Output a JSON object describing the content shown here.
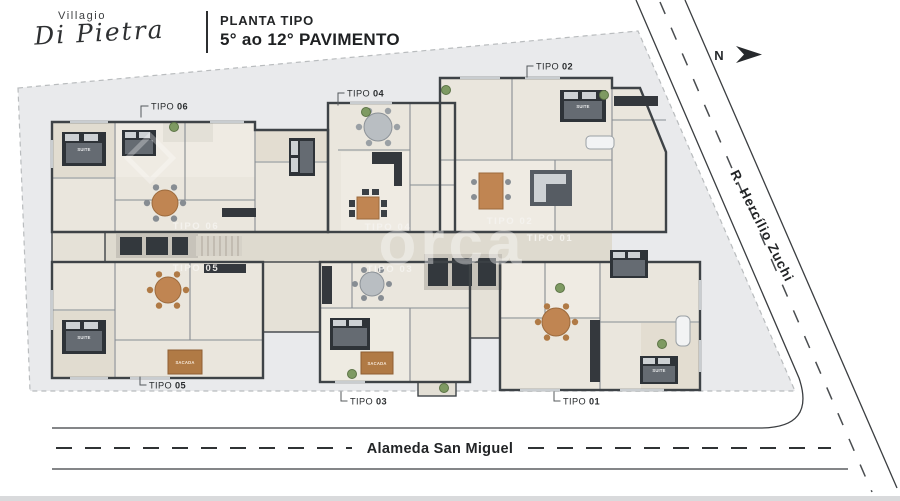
{
  "header": {
    "brand_top": "Villagio",
    "brand_script": "Di Pietra",
    "plan_label": "PLANTA TIPO",
    "plan_range": "5° ao 12° PAVIMENTO"
  },
  "compass": {
    "north": "N"
  },
  "streets": {
    "diagonal": "R. Hercílio Zuchi",
    "bottom": "Alameda San Miguel"
  },
  "callouts": [
    {
      "prefix": "TIPO",
      "num": "06"
    },
    {
      "prefix": "TIPO",
      "num": "04"
    },
    {
      "prefix": "TIPO",
      "num": "02"
    },
    {
      "prefix": "TIPO",
      "num": "05"
    },
    {
      "prefix": "TIPO",
      "num": "03"
    },
    {
      "prefix": "TIPO",
      "num": "01"
    }
  ],
  "floor_labels": {
    "tipo06": "TIPO 06",
    "tipo04": "TIPO 04",
    "tipo02": "TIPO 02",
    "tipo01": "TIPO 01",
    "tipo05": "TIPO 05",
    "tipo03": "TIPO 03"
  },
  "room_labels": {
    "suite": "SUITE",
    "sacada": "SACADA"
  },
  "watermark": "orca",
  "colors": {
    "lot": "#e9eaec",
    "floor": "#eae6dd",
    "wall": "#3e4347",
    "wood_accent": "#c08552",
    "sacada_accent": "#b07a45",
    "street_line": "#3b3e41",
    "footer_bar": "#d9dadc"
  }
}
